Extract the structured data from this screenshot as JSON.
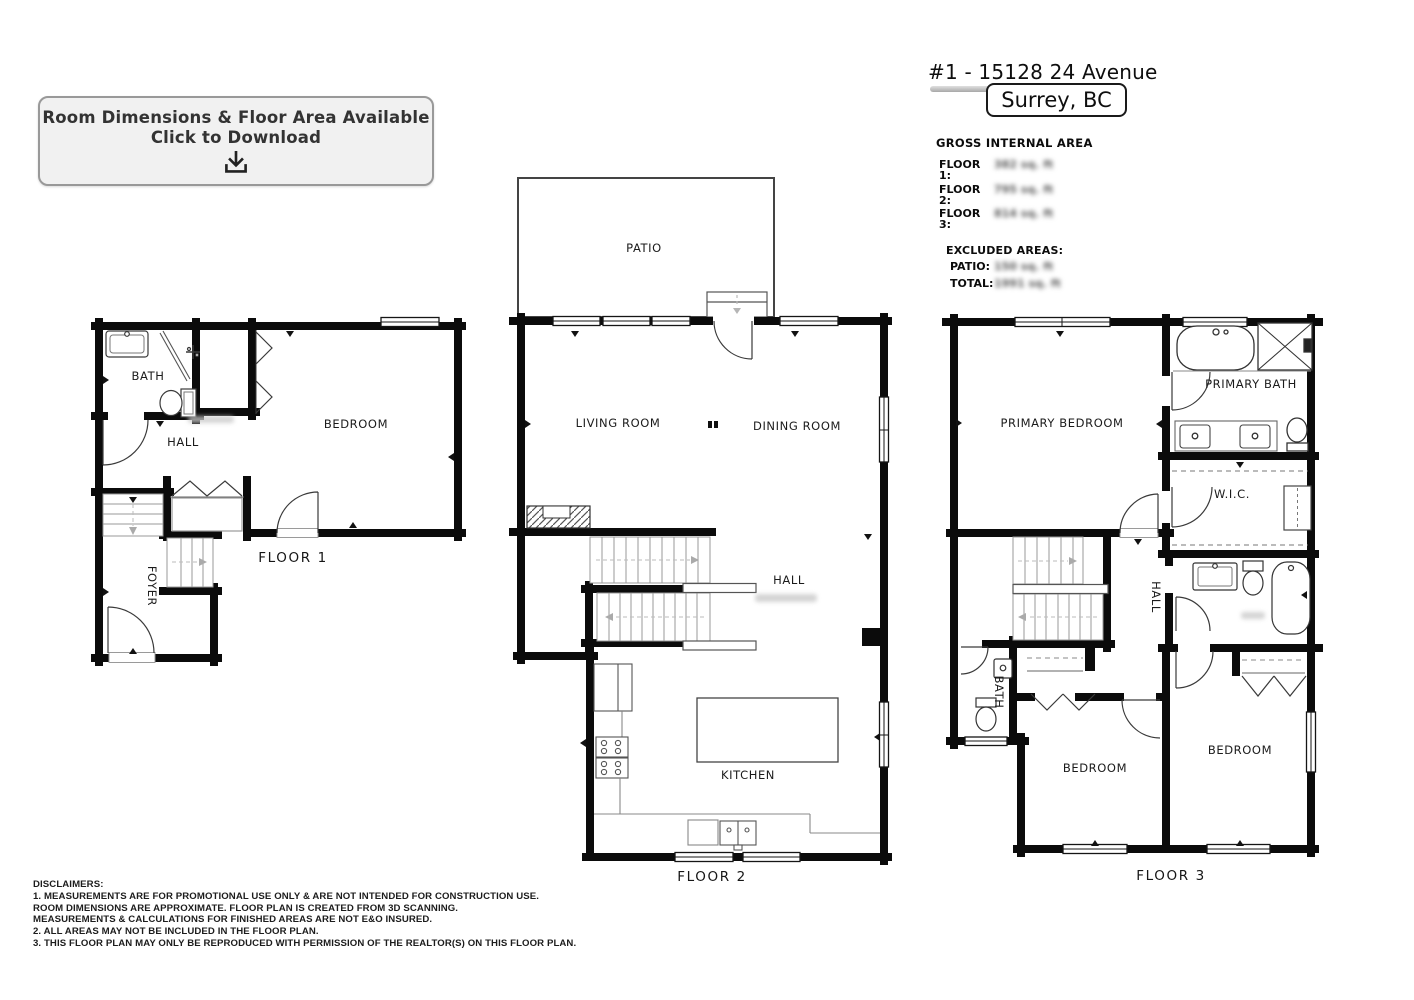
{
  "download_banner": {
    "line1": "Room Dimensions & Floor Area Available",
    "line2": "Click to Download"
  },
  "header": {
    "title": "#1 - 15128 24 Avenue",
    "location": "Surrey, BC"
  },
  "area_summary": {
    "title": "GROSS INTERNAL AREA",
    "floors": [
      {
        "label": "FLOOR 1:",
        "value": "382 sq. ft"
      },
      {
        "label": "FLOOR 2:",
        "value": "795 sq. ft"
      },
      {
        "label": "FLOOR 3:",
        "value": "814 sq. ft"
      }
    ],
    "excluded_title": "EXCLUDED AREAS:",
    "excluded": [
      {
        "label": "PATIO:",
        "value": "150 sq. ft"
      },
      {
        "label": "TOTAL:",
        "value": "1991 sq. ft"
      }
    ]
  },
  "floor1": {
    "caption": "FLOOR 1",
    "labels": {
      "bath": "BATH",
      "hall": "HALL",
      "bedroom": "BEDROOM",
      "foyer": "FOYER"
    }
  },
  "floor2": {
    "caption": "FLOOR 2",
    "labels": {
      "patio": "PATIO",
      "living_room": "LIVING ROOM",
      "dining_room": "DINING ROOM",
      "hall": "HALL",
      "kitchen": "KITCHEN"
    }
  },
  "floor3": {
    "caption": "FLOOR 3",
    "labels": {
      "primary_bedroom": "PRIMARY BEDROOM",
      "primary_bath": "PRIMARY BATH",
      "wic": "W.I.C.",
      "hall": "HALL",
      "bath": "BATH",
      "bedroom_left": "BEDROOM",
      "bedroom_right": "BEDROOM"
    }
  },
  "disclaimers": {
    "title": "DISCLAIMERS:",
    "lines": [
      "1. MEASUREMENTS ARE FOR PROMOTIONAL USE ONLY & ARE NOT INTENDED FOR CONSTRUCTION USE.",
      "ROOM DIMENSIONS ARE APPROXIMATE. FLOOR PLAN IS CREATED FROM 3D SCANNING.",
      "MEASUREMENTS & CALCULATIONS FOR FINISHED AREAS ARE NOT E&O INSURED.",
      "2. ALL AREAS MAY NOT BE INCLUDED IN THE FLOOR PLAN.",
      "3. THIS FLOOR PLAN MAY ONLY BE REPRODUCED WITH PERMISSION OF THE REALTOR(S) ON THIS FLOOR PLAN."
    ]
  }
}
